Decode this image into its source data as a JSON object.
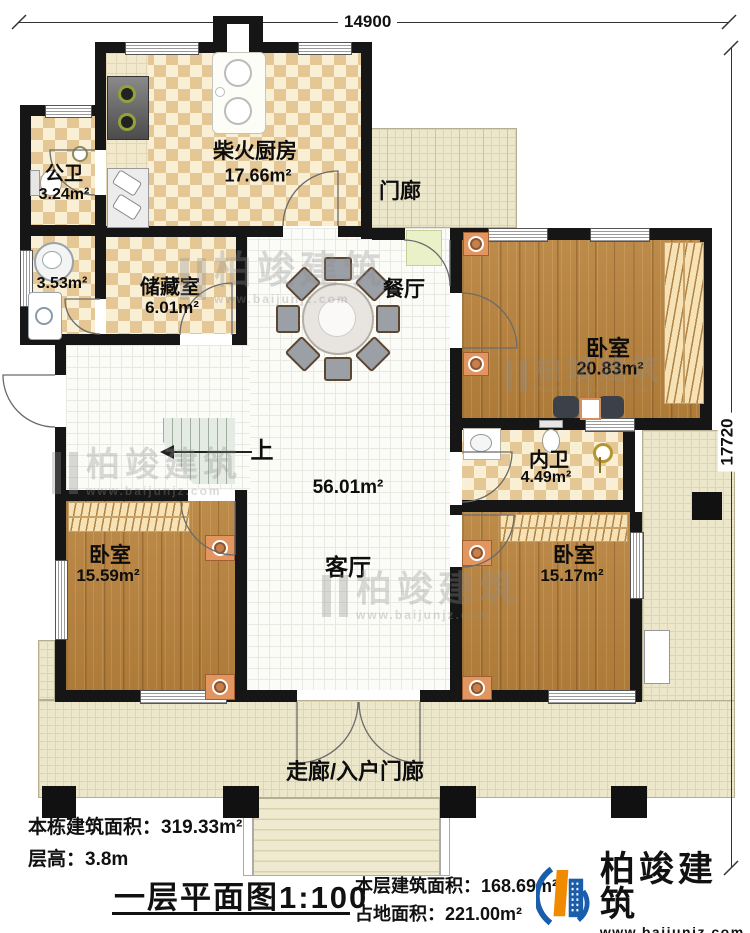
{
  "dimensions": {
    "top": "14900",
    "right": "17720"
  },
  "rooms": {
    "public_bath": {
      "name": "公卫",
      "area": "3.24m²"
    },
    "washroom": {
      "area": "3.53m²"
    },
    "kitchen": {
      "name": "柴火厨房",
      "area": "17.66m²"
    },
    "storage": {
      "name": "储藏室",
      "area": "6.01m²"
    },
    "porch": {
      "name": "门廊"
    },
    "dining": {
      "name": "餐厅"
    },
    "bedroom_ne": {
      "name": "卧室",
      "area": "20.83m²"
    },
    "inner_bath": {
      "name": "内卫",
      "area": "4.49m²"
    },
    "living": {
      "name": "客厅",
      "area": "56.01m²"
    },
    "bedroom_sw": {
      "name": "卧室",
      "area": "15.59m²"
    },
    "bedroom_se": {
      "name": "卧室",
      "area": "15.17m²"
    },
    "corridor": {
      "name": "走廊/入户门廊"
    }
  },
  "stairs": {
    "up_label": "上"
  },
  "footer": {
    "total_area_label": "本栋建筑面积：",
    "total_area_value": "319.33m²",
    "floor_height_label": "层高：",
    "floor_height_value": "3.8m",
    "plan_title": "一层平面图",
    "plan_scale": "1:100",
    "floor_area_label": "本层建筑面积：",
    "floor_area_value": "168.69m²",
    "land_area_label": "占地面积：",
    "land_area_value": "221.00m²"
  },
  "brand": {
    "name": "柏竣建筑",
    "website": "www.baijunjz.com"
  },
  "watermark": {
    "name": "柏竣建筑",
    "website": "www.baijunjz.com"
  },
  "colors": {
    "wall": "#161616",
    "checker": "#e5c795",
    "wood": "#b8823c",
    "porch": "#ece6ca",
    "bed": "#72c5dd",
    "logo_blue": "#1a5dab",
    "logo_orange": "#f08a00"
  }
}
